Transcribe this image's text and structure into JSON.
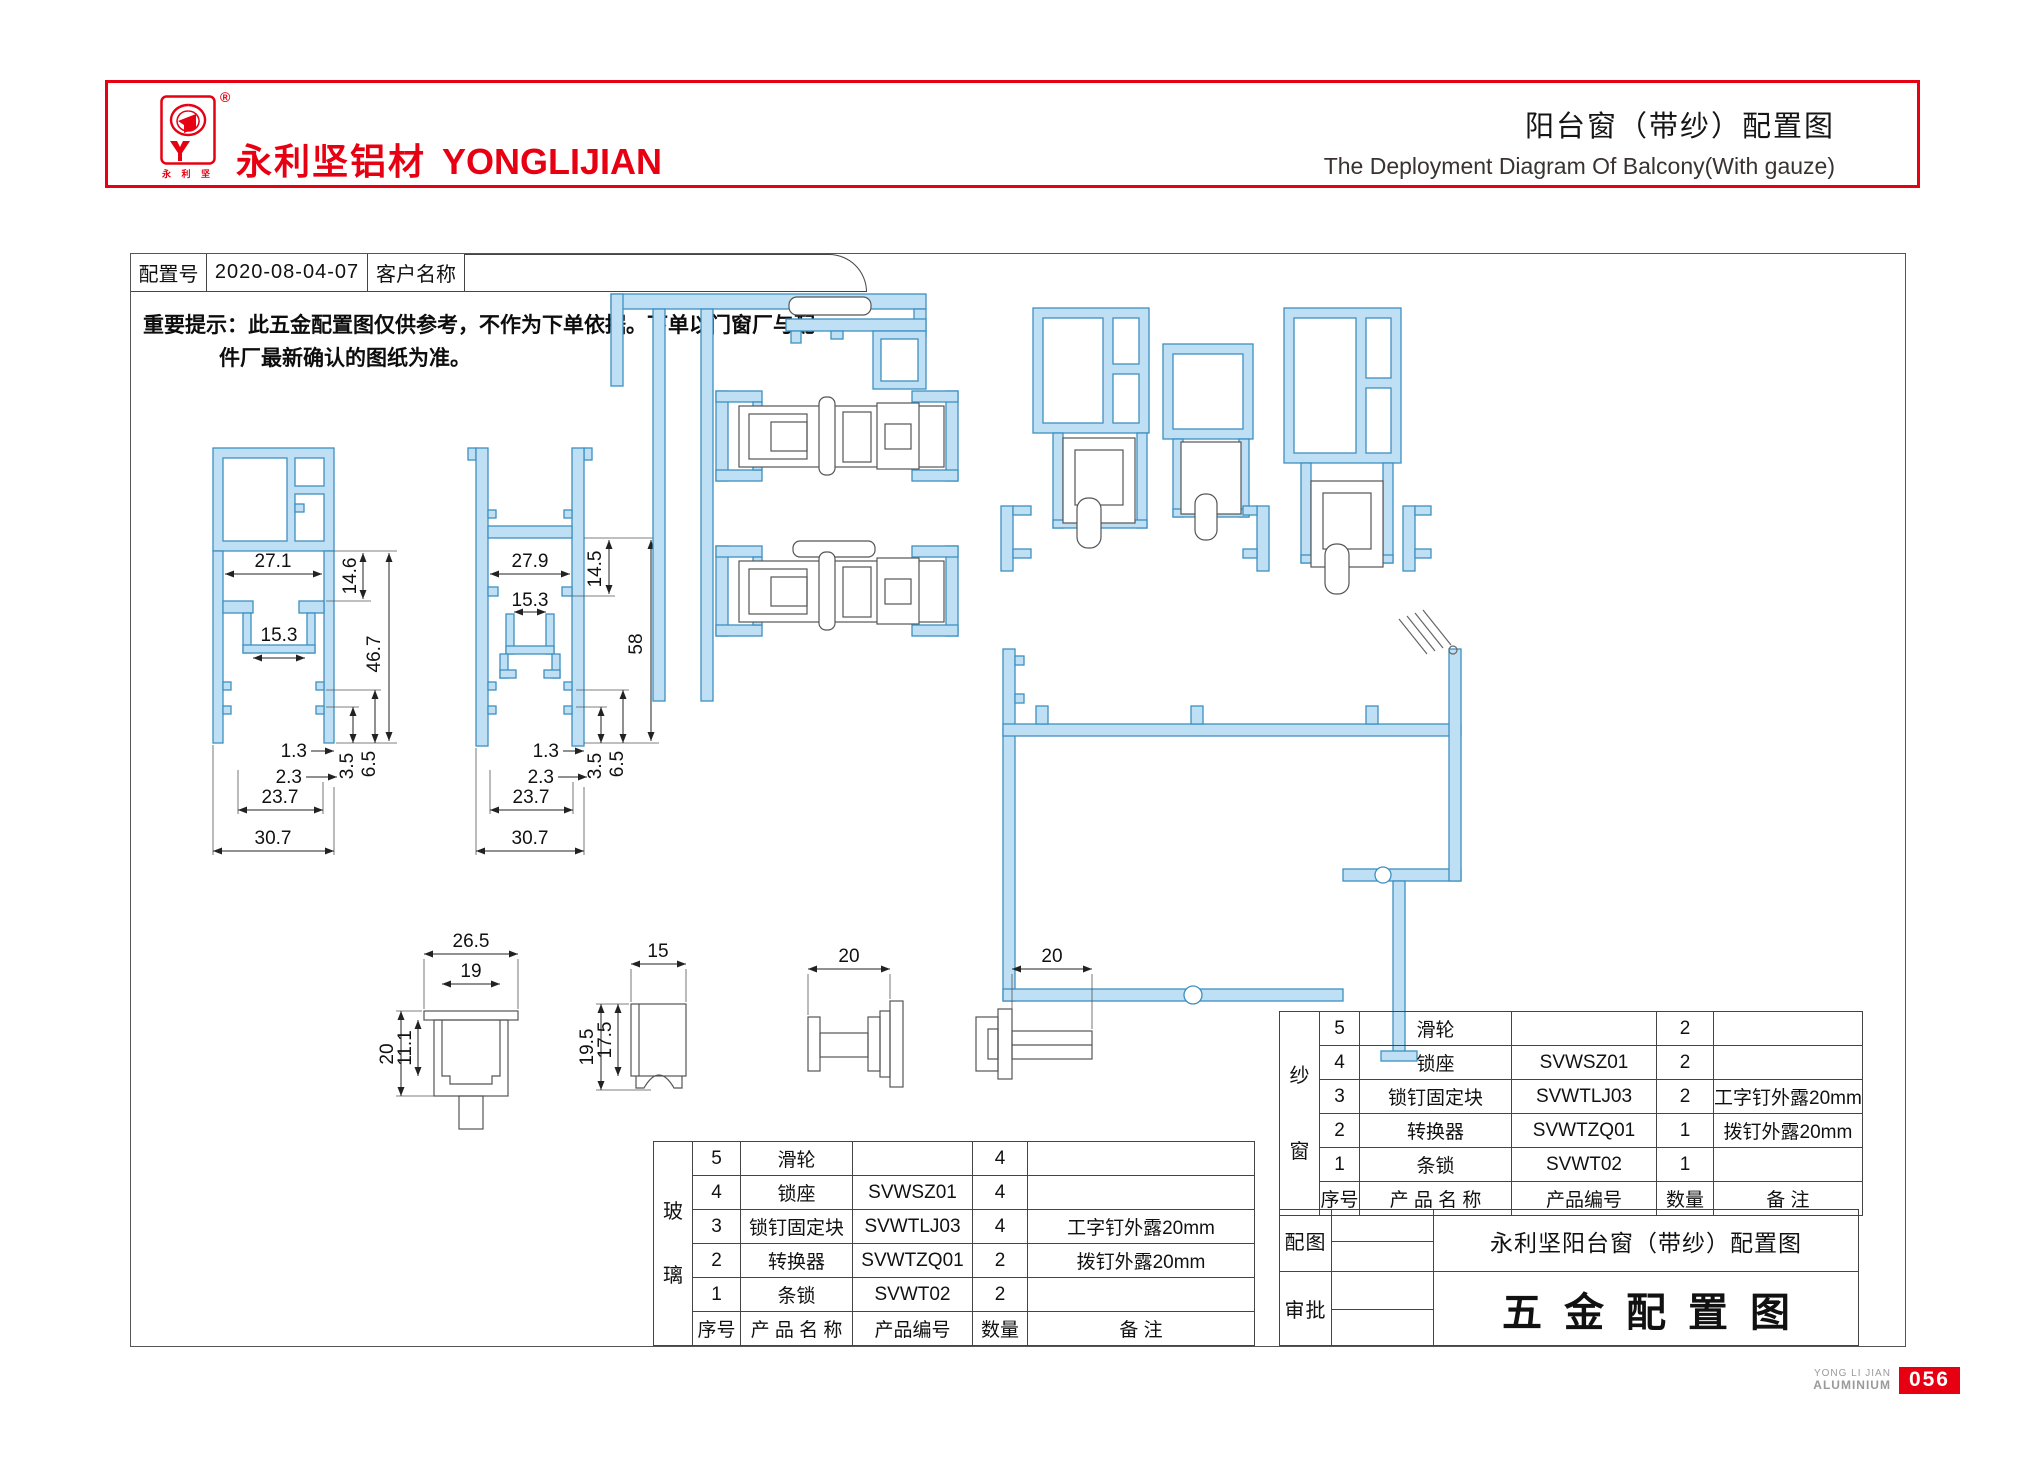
{
  "header": {
    "brand_cn": "永利坚铝材",
    "brand_en": "YONGLIJIAN",
    "registered_mark": "®",
    "logo_sub_text": "永 利 坚",
    "title_cn": "阳台窗（带纱）配置图",
    "title_en": "The Deployment Diagram Of Balcony(With gauze)",
    "accent_red": "#e60012"
  },
  "config_row": {
    "config_label": "配置号",
    "config_value": "2020-08-04-07",
    "customer_label": "客户名称",
    "customer_value": ""
  },
  "notice": {
    "line1": "重要提示：此五金配置图仅供参考，不作为下单依据。下单以门窗厂与配",
    "line2": "件厂最新确认的图纸为准。"
  },
  "dims": {
    "p1": {
      "top_w": "27.1",
      "top_h": "14.6",
      "slot_w": "15.3",
      "total_h": "46.7",
      "t1": "1.3",
      "t2": "2.3",
      "t3": "3.5",
      "t4": "6.5",
      "inner_w": "23.7",
      "outer_w": "30.7"
    },
    "p2": {
      "top_w": "27.9",
      "top_h": "14.5",
      "slot_w": "15.3",
      "total_h": "58",
      "t1": "1.3",
      "t2": "2.3",
      "t3": "3.5",
      "t4": "6.5",
      "inner_w": "23.7",
      "outer_w": "30.7"
    },
    "lock_seat": {
      "outer_w": "26.5",
      "inner_w": "19",
      "outer_h": "20",
      "inner_h": "11.1"
    },
    "roller": {
      "w": "15",
      "outer_h": "19.5",
      "inner_h": "17.5"
    },
    "ipin": {
      "w": "20"
    },
    "pullpin": {
      "w": "20"
    }
  },
  "glass_table": {
    "group_char1": "玻",
    "group_char2": "璃",
    "rows": [
      {
        "no": "5",
        "name": "滑轮",
        "code": "",
        "qty": "4",
        "note": ""
      },
      {
        "no": "4",
        "name": "锁座",
        "code": "SVWSZ01",
        "qty": "4",
        "note": ""
      },
      {
        "no": "3",
        "name": "锁钉固定块",
        "code": "SVWTLJ03",
        "qty": "4",
        "note": "工字钉外露20mm"
      },
      {
        "no": "2",
        "name": "转换器",
        "code": "SVWTZQ01",
        "qty": "2",
        "note": "拨钉外露20mm"
      },
      {
        "no": "1",
        "name": "条锁",
        "code": "SVWT02",
        "qty": "2",
        "note": ""
      }
    ],
    "header": {
      "no": "序号",
      "name": "产 品 名 称",
      "code": "产品编号",
      "qty": "数量",
      "note": "备 注"
    }
  },
  "gauze_table": {
    "group_char1": "纱",
    "group_char2": "窗",
    "rows": [
      {
        "no": "5",
        "name": "滑轮",
        "code": "",
        "qty": "2",
        "note": ""
      },
      {
        "no": "4",
        "name": "锁座",
        "code": "SVWSZ01",
        "qty": "2",
        "note": ""
      },
      {
        "no": "3",
        "name": "锁钉固定块",
        "code": "SVWTLJ03",
        "qty": "2",
        "note": "工字钉外露20mm"
      },
      {
        "no": "2",
        "name": "转换器",
        "code": "SVWTZQ01",
        "qty": "1",
        "note": "拨钉外露20mm"
      },
      {
        "no": "1",
        "name": "条锁",
        "code": "SVWT02",
        "qty": "1",
        "note": ""
      }
    ],
    "header": {
      "no": "序号",
      "name": "产 品 名 称",
      "code": "产品编号",
      "qty": "数量",
      "note": "备 注"
    }
  },
  "title_block": {
    "row1_label": "配图",
    "row2_label": "审批",
    "subtitle": "永利坚阳台窗（带纱）配置图",
    "main_title": "五金配置图"
  },
  "footer": {
    "brand_line1": "YONG LI JIAN",
    "brand_line2": "ALUMINIUM",
    "page_number": "056"
  }
}
